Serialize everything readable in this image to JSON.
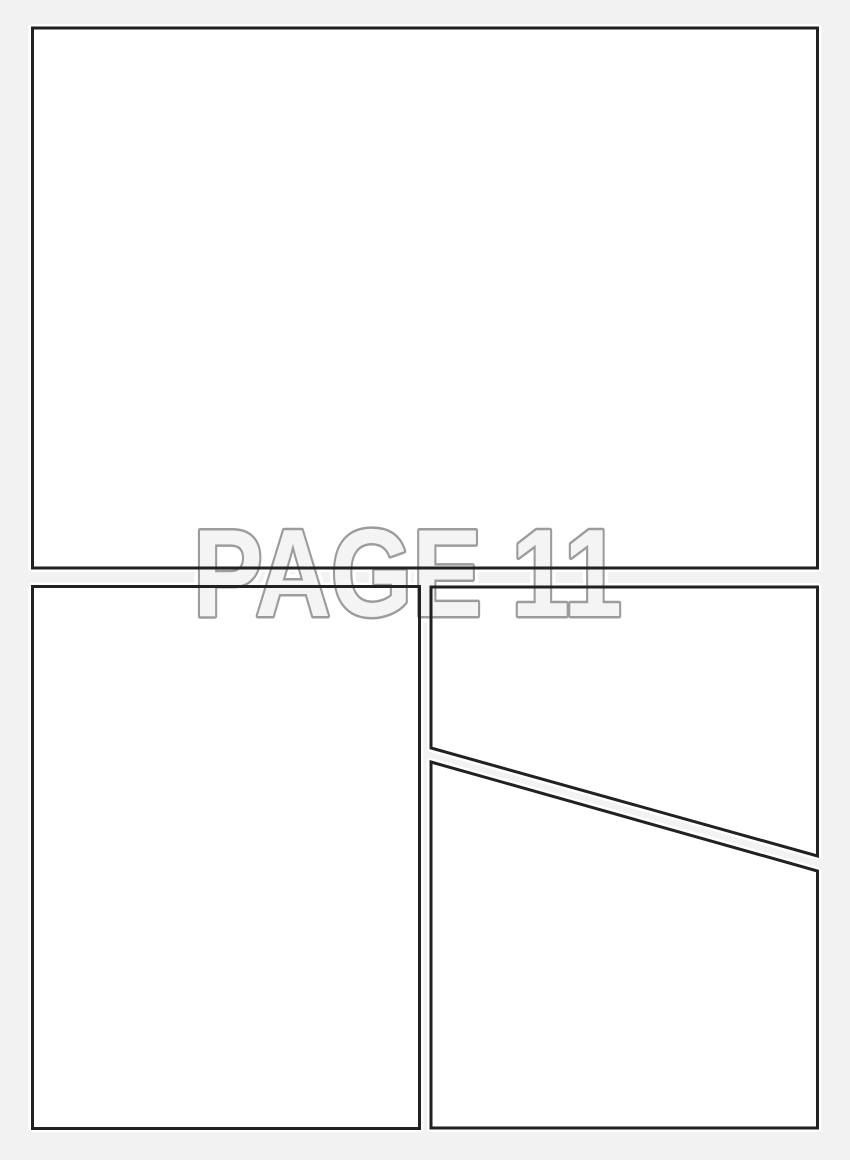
{
  "page": {
    "watermark": "PAGE 11"
  },
  "panels": [
    {
      "name": "top-full-width-panel",
      "shape": "rectangle"
    },
    {
      "name": "bottom-left-panel",
      "shape": "rectangle"
    },
    {
      "name": "bottom-right-upper-panel",
      "shape": "quadrilateral-slanted-bottom"
    },
    {
      "name": "bottom-right-lower-panel",
      "shape": "quadrilateral-slanted-top"
    }
  ],
  "colors": {
    "page_background": "#f2f2f2",
    "panel_fill": "#ffffff",
    "panel_border": "#212121",
    "watermark_text_fill": "#f4f4f4",
    "watermark_text_outline": "#9c9c9c",
    "watermark_halo": "#ffffff"
  }
}
